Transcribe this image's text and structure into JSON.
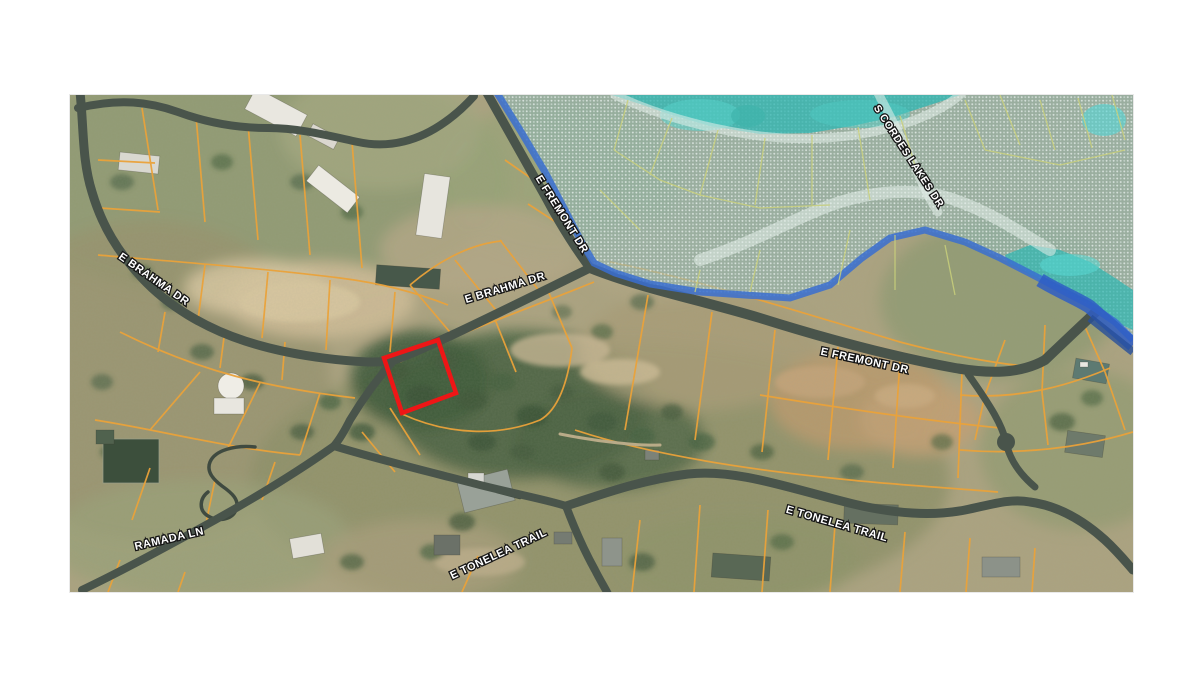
{
  "map": {
    "description": "Satellite parcel map with flood zone overlay and highlighted lot",
    "highlight": {
      "name": "subject-parcel",
      "outline_color": "#ee1616"
    },
    "overlay": {
      "flood_zone_fill": "#35b8b4",
      "flood_edge_color": "#3a6fd0",
      "hatch_color": "#dfe9e6"
    },
    "parcel_line_color": "#eaa23a",
    "road_color": "#49544b",
    "road_labels": [
      {
        "id": "brahma-west",
        "text": "E BRAHMA DR"
      },
      {
        "id": "brahma-center",
        "text": "E BRAHMA DR"
      },
      {
        "id": "fremont-north",
        "text": "E FREMONT DR"
      },
      {
        "id": "fremont-east",
        "text": "E FREMONT DR"
      },
      {
        "id": "cordes-lakes",
        "text": "S CORDES LAKES DR"
      },
      {
        "id": "ramada",
        "text": "RAMADA LN"
      },
      {
        "id": "tonelea-south",
        "text": "E TONELEA TRAIL"
      },
      {
        "id": "tonelea-east",
        "text": "E TONELEA TRAIL"
      }
    ]
  }
}
